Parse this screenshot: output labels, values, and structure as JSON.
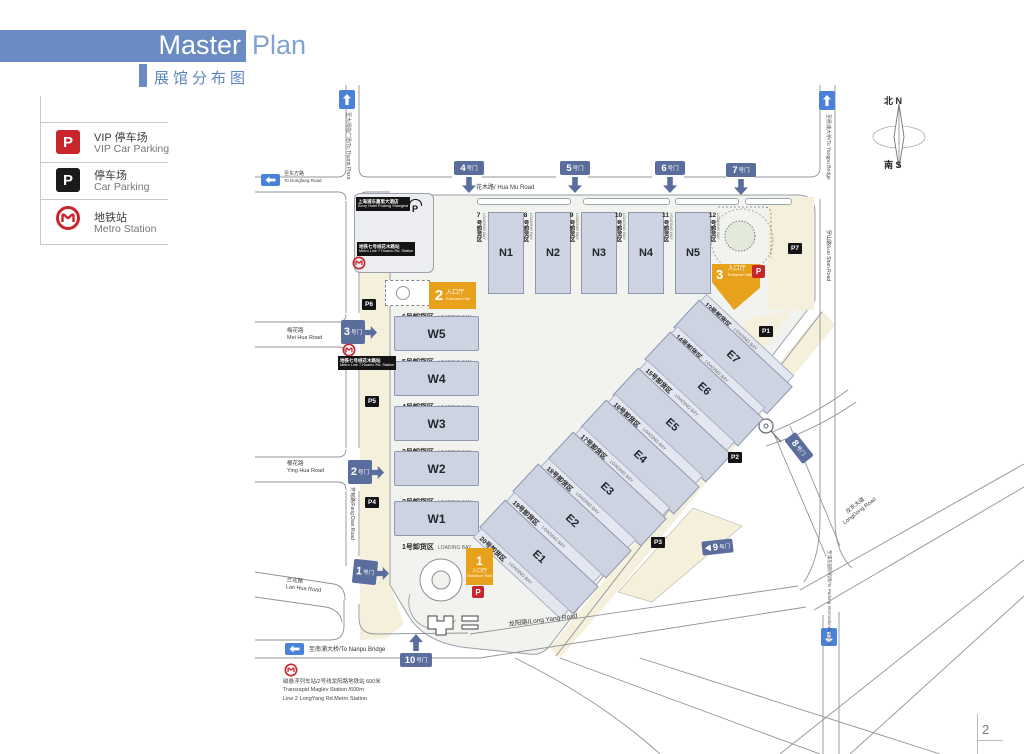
{
  "header": {
    "title_main": "Master",
    "title_accent": "Plan",
    "subtitle": "展馆分布图"
  },
  "legend": {
    "items": [
      {
        "symbol": "P",
        "cn": "VIP 停车场",
        "en": "VIP Car Parking"
      },
      {
        "symbol": "P",
        "cn": "停车场",
        "en": "Car Parking"
      },
      {
        "cn": "地铁站",
        "en": "Metro Station"
      }
    ]
  },
  "compass": {
    "north": "北 N",
    "south": "南 S"
  },
  "halls": {
    "n": [
      "N1",
      "N2",
      "N3",
      "N4",
      "N5"
    ],
    "w": [
      "W5",
      "W4",
      "W3",
      "W2",
      "W1"
    ],
    "e": [
      "E7",
      "E6",
      "E5",
      "E4",
      "E3",
      "E2",
      "E1"
    ]
  },
  "bays": {
    "en": "LOADING BAY",
    "n": [
      {
        "num": "7",
        "rest": "号卸货区"
      },
      {
        "num": "8",
        "rest": "号卸货区"
      },
      {
        "num": "9",
        "rest": "号卸货区"
      },
      {
        "num": "10",
        "rest": "号卸货区"
      },
      {
        "num": "11",
        "rest": "号卸货区"
      },
      {
        "num": "12",
        "rest": "号卸货区"
      }
    ],
    "w": [
      "6号卸货区",
      "5号卸货区",
      "4号卸货区",
      "3号卸货区",
      "2号卸货区",
      "1号卸货区"
    ],
    "e": [
      "13号卸货区",
      "14号卸货区",
      "15号卸货区",
      "16号卸货区",
      "17号卸货区",
      "18号卸货区",
      "19号卸货区",
      "20号卸货区"
    ]
  },
  "entrances": {
    "cn": "入口厅",
    "en": "Entrance Hall",
    "nums": [
      "1",
      "2",
      "3"
    ]
  },
  "gates": {
    "suffix": "号门",
    "nums": [
      "1",
      "2",
      "3",
      "4",
      "5",
      "6",
      "7",
      "8",
      "9",
      "10"
    ]
  },
  "parking": [
    "P1",
    "P2",
    "P3",
    "P4",
    "P5",
    "P6",
    "P7"
  ],
  "markers": {
    "p": "P"
  },
  "roads": {
    "hua_mu": "花木路/ Hua Mu Road",
    "mei_hua_cn": "梅花路",
    "mei_hua_en": "Mei Hua Road",
    "ying_hua_cn": "樱花路",
    "ying_hua_en": "Ying Hua Road",
    "lan_hua_cn": "兰花路",
    "lan_hua_en": "Lan Hua Road",
    "fang_dian": "芳甸路/Fang Dian Road",
    "luo_shan": "罗山路/Luo Shan Road",
    "long_yang": "龙阳路/Long Yang Road",
    "long_dong_cn": "龙东大道",
    "long_dong_en": "LongDong Road"
  },
  "signs": {
    "to_thumb": "至大拇指广场/To Thumb Plaza",
    "to_yangpu": "至杨浦大桥/To Yangpu Bridge",
    "to_dongfang_cn": "至东方路",
    "to_dongfang_en": "To Dongfang Road",
    "to_nanpu": "至南浦大桥/To Nanpu Bridge",
    "to_airport": "至浦东国际机场/To Pudong International Airport"
  },
  "hotel": {
    "cn": "上海浦东嘉里大酒店",
    "en": "Kerry Hotel Pudong Shanghai"
  },
  "metro_line7": {
    "cn": "地铁七号线花木路站",
    "en": "Metro Line 7 Huamu Rd. Station"
  },
  "maglev": {
    "l1": "磁悬浮列车站/2号线龙阳路地铁站  600米",
    "l2": "Transrapid Maglev Station  /600m",
    "l3": "Line 2 LongYang Rd.Metro Station"
  },
  "page": {
    "number": "2"
  }
}
